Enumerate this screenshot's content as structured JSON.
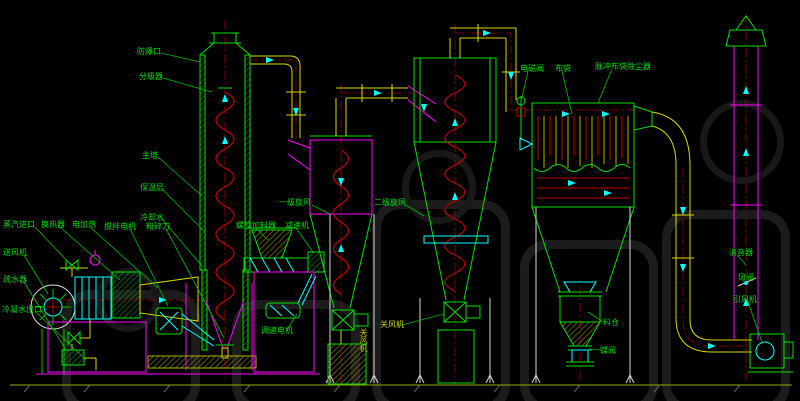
{
  "drawing_type": "cad-process-flow-diagram",
  "labels": {
    "explosion_vent": "防爆口",
    "classifier": "分级器",
    "main_tower": "主塔",
    "insulation_layer": "保温层",
    "cooling_water": "冷却水",
    "steam_inlet": "蒸汽进口",
    "heat_exchanger": "换热器",
    "electric_heater": "电加热",
    "agitator_motor": "搅拌电机",
    "crushing_knife": "粉碎刀",
    "supply_fan": "送风机",
    "steam_trap": "疏水器",
    "condensate_outlet": "冷凝水出口",
    "screw_feeder": "螺旋加料器",
    "gear_reducer": "减速机",
    "speed_motor": "调速电机",
    "cyclone_1": "一级旋风",
    "cyclone_2": "二级旋风",
    "rotary_valve_1": "关风机",
    "rotary_valve_2": "关风机",
    "solenoid_valve": "电磁阀",
    "cloth_bag": "布袋",
    "pulse_bag_dust_collector": "脉冲布袋除尘器",
    "hopper": "料仓",
    "butterfly_valve": "蝶阀",
    "muffler": "消音器",
    "air_valve": "风阀",
    "induced_draft_fan": "引风机"
  },
  "colors": {
    "background": "#000000",
    "line_green": "#00e000",
    "line_magenta": "#ff00ff",
    "line_cyan": "#00ffff",
    "line_yellow": "#d9d900",
    "line_red": "#c00000",
    "line_white": "#d8d8d8",
    "label_green": "#00dd00",
    "watermark": "#1c1c1c"
  }
}
